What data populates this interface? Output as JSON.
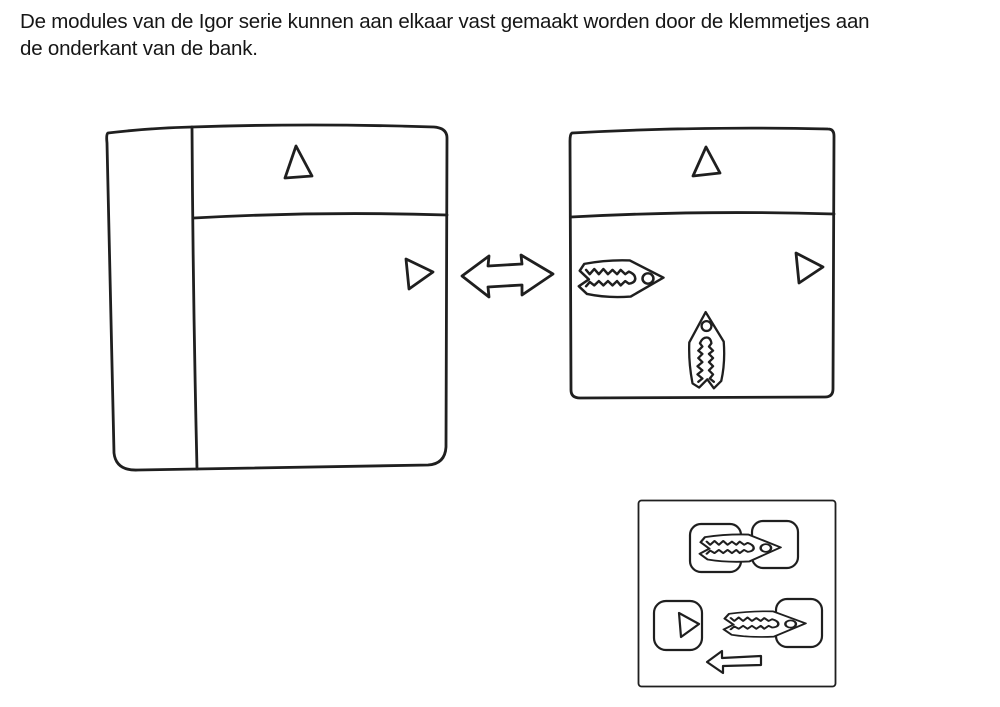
{
  "caption": {
    "line1": "De modules van de Igor serie kunnen aan elkaar vast gemaakt worden door de klemmetjes aan",
    "line2": "de onderkant van de bank."
  },
  "colors": {
    "ink": "#1f1f1f",
    "background": "#ffffff"
  },
  "icons": {
    "left_module_markers": [
      "up-triangle-icon",
      "right-triangle-icon"
    ],
    "connector": "double-arrow-icon",
    "right_module_markers": [
      "up-triangle-icon",
      "right-triangle-icon",
      "clip-left-icon",
      "clip-down-icon"
    ],
    "inset_markers": [
      "connected-clip-icon",
      "right-triangle-icon",
      "clip-left-icon",
      "left-arrow-icon"
    ]
  }
}
